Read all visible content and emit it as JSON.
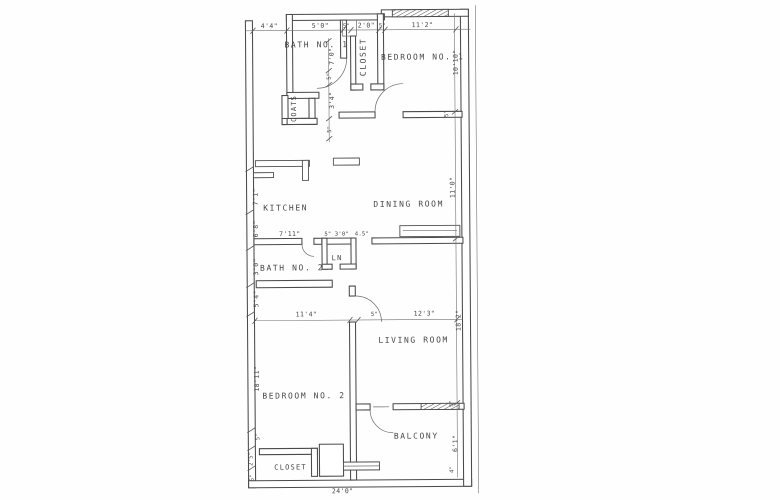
{
  "colors": {
    "ink": "#474747",
    "paper": "#fefefe"
  },
  "rooms": {
    "bath1": "BATH NO. 1",
    "closet1": "CLOSET",
    "coats": "COATS",
    "bedroom1": "BEDROOM NO. 1",
    "kitchen": "KITCHEN",
    "dining": "DINING ROOM",
    "linen": "LN",
    "bath2": "BATH NO. 2",
    "bedroom2": "BEDROOM NO. 2",
    "living": "LIVING ROOM",
    "closet2": "CLOSET",
    "balcony": "BALCONY"
  },
  "dims": {
    "top1": "4'4\"",
    "top2": "5'0\"",
    "top3": "5\"",
    "top4": "2'0\"",
    "top5": "5\"",
    "top6": "11'2\"",
    "hall1": "7'0\"",
    "hall2": "5\"",
    "hall3": "3'4\"",
    "hall4": "5\"",
    "right1": "10'10\"",
    "right2": "5\"",
    "right3": "11'0\"",
    "right4": "18'2\"",
    "bal1": "5\"",
    "bal2": "6'1\"",
    "bal3": "4\"",
    "left1": "7'1\"",
    "left2": "6'8\"",
    "left3": "3'0\"",
    "left4": "5'4\"",
    "left5": "18'11\"",
    "left6": "5\"",
    "left7": "2'5\"",
    "left8": "6\"",
    "bath2row1": "7'11\"",
    "bath2row2": "5\"",
    "bath2row3": "3'0\"",
    "bath2row4": "4.5\"",
    "mid1": "11'4\"",
    "mid2": "5\"",
    "mid3": "12'3\"",
    "bottom1": "24'0\""
  }
}
